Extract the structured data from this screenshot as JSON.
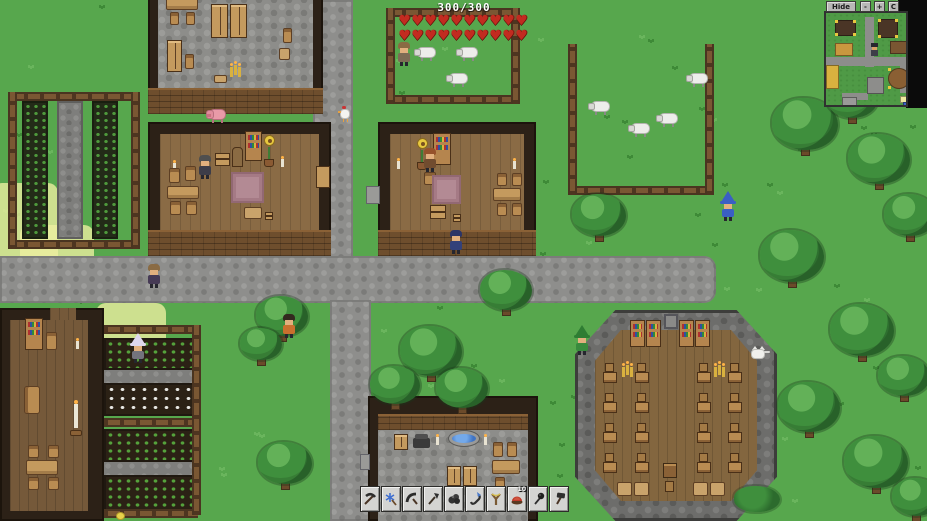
{
  "hud": {
    "health": {
      "display": "300/300",
      "current": 300,
      "max": 300,
      "rows": 2,
      "per_row": 10,
      "heart_color": "#c22b20"
    }
  },
  "minimap": {
    "hide_label": "Hide",
    "zoom_out_label": "-",
    "zoom_in_label": "+",
    "center_label": "C",
    "colors": {
      "grass": "#4f9a46",
      "road": "#8d8d8b",
      "border": "#303030"
    },
    "roads": [
      {
        "x": 39,
        "y": 4,
        "w": 9,
        "h": 50
      },
      {
        "x": 0,
        "y": 44,
        "w": 84,
        "h": 9
      },
      {
        "x": 74,
        "y": 52,
        "w": 9,
        "h": 28
      },
      {
        "x": 16,
        "y": 80,
        "w": 26,
        "h": 7
      }
    ],
    "buildings": [
      {
        "name": "storage-house",
        "x": 9,
        "y": 7,
        "w": 21,
        "h": 16,
        "color": "#4a3526",
        "dots": true
      },
      {
        "name": "left-house",
        "x": 9,
        "y": 30,
        "w": 18,
        "h": 13,
        "color": "#c9973f"
      },
      {
        "name": "center-house",
        "x": 52,
        "y": 6,
        "w": 20,
        "h": 19,
        "color": "#4a3526",
        "dots": true
      },
      {
        "name": "right-house",
        "x": 64,
        "y": 28,
        "w": 17,
        "h": 13,
        "color": "#7a5632"
      },
      {
        "name": "library",
        "x": 62,
        "y": 55,
        "w": 22,
        "h": 21,
        "color": "#8a5f33",
        "round": true,
        "dots": true
      },
      {
        "name": "tavern",
        "x": 0,
        "y": 52,
        "w": 13,
        "h": 24,
        "color": "#d9b13f"
      },
      {
        "name": "smithy",
        "x": 41,
        "y": 64,
        "w": 17,
        "h": 17,
        "color": "#8d8d8b"
      },
      {
        "name": "shed",
        "x": 16,
        "y": 84,
        "w": 15,
        "h": 9,
        "color": "#9a9a98"
      },
      {
        "name": "marker-yellow",
        "x": 74,
        "y": 83,
        "w": 9,
        "h": 7,
        "color": "#efe9a0"
      },
      {
        "name": "marker-blue",
        "x": 77,
        "y": 89,
        "w": 7,
        "h": 6,
        "color": "#3f63c9"
      }
    ]
  },
  "hotbar": {
    "slots": [
      {
        "item": "pickaxe"
      },
      {
        "item": "frost-staff"
      },
      {
        "item": "scythe"
      },
      {
        "item": "spear"
      },
      {
        "item": "ore-chunk"
      },
      {
        "item": "grappling-hook"
      },
      {
        "item": "slingshot"
      },
      {
        "item": "pot-pie",
        "count": "10"
      },
      {
        "item": "mace"
      },
      {
        "item": "hammer"
      }
    ]
  },
  "scene": {
    "characters": [
      {
        "id": "villager-on-road",
        "x": 147,
        "y": 264,
        "hat": "hair",
        "hatColor": "#8a6b43",
        "bodyColor": "#463a55"
      },
      {
        "id": "player",
        "x": 449,
        "y": 230,
        "hat": "hair",
        "hatColor": "#2c3566",
        "bodyColor": "#33417a"
      },
      {
        "id": "wizard",
        "x": 721,
        "y": 194,
        "hat": "pointy",
        "hatColor": "#3a5fc4",
        "bodyColor": "#3a5fc4"
      },
      {
        "id": "orange-villager",
        "x": 282,
        "y": 314,
        "hat": "hair",
        "hatColor": "#33291f",
        "bodyColor": "#c9702e"
      },
      {
        "id": "farmer",
        "x": 131,
        "y": 336,
        "hat": "pointy",
        "hatColor": "#ded7ee",
        "bodyColor": "#73737d"
      },
      {
        "id": "gnome",
        "x": 575,
        "y": 328,
        "hat": "pointy",
        "hatColor": "#2f7d33",
        "bodyColor": "#398a3d"
      },
      {
        "id": "shepherd",
        "x": 397,
        "y": 42,
        "hat": "hair",
        "hatColor": "#8a6b43",
        "bodyColor": "#7d6c55"
      },
      {
        "id": "indoor-npc-left-house",
        "x": 198,
        "y": 155,
        "hat": "hair",
        "hatColor": "#4f4f4f",
        "bodyColor": "#3d3d49"
      },
      {
        "id": "indoor-npc-center-house",
        "x": 423,
        "y": 148,
        "hat": "hair",
        "hatColor": "#96522b",
        "bodyColor": "#714c2f"
      }
    ],
    "animals": [
      {
        "type": "sheep",
        "x": 414,
        "y": 44
      },
      {
        "type": "sheep",
        "x": 456,
        "y": 44
      },
      {
        "type": "sheep",
        "x": 446,
        "y": 70
      },
      {
        "type": "sheep",
        "x": 588,
        "y": 98
      },
      {
        "type": "sheep",
        "x": 628,
        "y": 120
      },
      {
        "type": "sheep",
        "x": 656,
        "y": 110
      },
      {
        "type": "sheep",
        "x": 686,
        "y": 70
      },
      {
        "type": "pig",
        "x": 206,
        "y": 106
      },
      {
        "type": "chicken",
        "x": 338,
        "y": 106
      },
      {
        "type": "cat",
        "x": 750,
        "y": 346
      },
      {
        "type": "chick",
        "x": 116,
        "y": 508
      }
    ],
    "trees": [
      {
        "x": 772,
        "y": 98,
        "w": 66,
        "h": 58
      },
      {
        "x": 826,
        "y": 78,
        "w": 52,
        "h": 46
      },
      {
        "x": 848,
        "y": 134,
        "w": 62,
        "h": 56
      },
      {
        "x": 884,
        "y": 194,
        "w": 52,
        "h": 48
      },
      {
        "x": 760,
        "y": 230,
        "w": 64,
        "h": 58
      },
      {
        "x": 830,
        "y": 304,
        "w": 64,
        "h": 58
      },
      {
        "x": 878,
        "y": 356,
        "w": 52,
        "h": 46
      },
      {
        "x": 778,
        "y": 382,
        "w": 62,
        "h": 56
      },
      {
        "x": 844,
        "y": 436,
        "w": 64,
        "h": 58
      },
      {
        "x": 892,
        "y": 478,
        "w": 48,
        "h": 44
      },
      {
        "x": 572,
        "y": 194,
        "w": 54,
        "h": 48
      },
      {
        "x": 480,
        "y": 270,
        "w": 52,
        "h": 46
      },
      {
        "x": 400,
        "y": 326,
        "w": 62,
        "h": 56
      },
      {
        "x": 370,
        "y": 366,
        "w": 50,
        "h": 44
      },
      {
        "x": 436,
        "y": 368,
        "w": 52,
        "h": 46
      },
      {
        "x": 256,
        "y": 296,
        "w": 52,
        "h": 46
      },
      {
        "x": 240,
        "y": 328,
        "w": 42,
        "h": 38
      },
      {
        "x": 258,
        "y": 442,
        "w": 54,
        "h": 48
      }
    ],
    "bushes": [
      {
        "x": 734,
        "y": 486,
        "w": 46,
        "h": 26
      }
    ]
  }
}
